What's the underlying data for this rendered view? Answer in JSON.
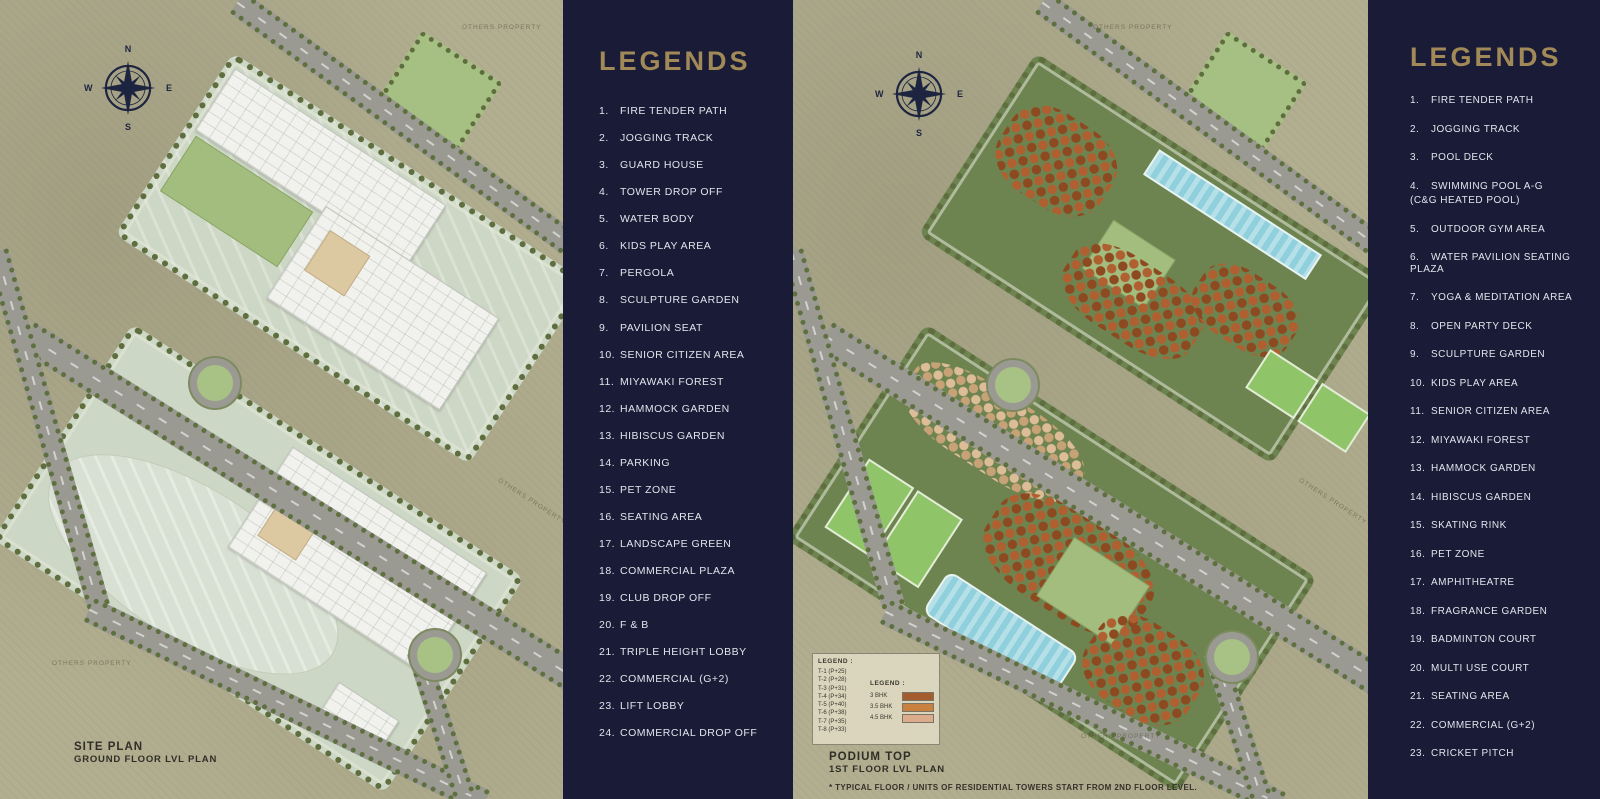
{
  "colors": {
    "panel_navy": "#191b37",
    "title_gold": "#a18a58",
    "list_text": "#e2e4ec",
    "map_ground": "#b2ae90",
    "road_gray": "#9a9a92",
    "deck_sage": "#cdd7c5",
    "lawn_green": "#a3bd7f",
    "podium_green": "#6e8450",
    "tower_rust": "#a85a28",
    "tower_beige": "#d8b894",
    "pool_blue": "#8fd0dc",
    "court_green": "#8fc468",
    "compass_navy": "#1d2440"
  },
  "left_map": {
    "plan_title": "SITE PLAN",
    "plan_subtitle": "GROUND FLOOR LVL PLAN",
    "property_label": "OTHERS PROPERTY",
    "compass": {
      "n": "N",
      "e": "E",
      "s": "S",
      "w": "W"
    }
  },
  "left_panel": {
    "title": "LEGENDS",
    "items": [
      {
        "n": "1.",
        "label": "FIRE TENDER PATH"
      },
      {
        "n": "2.",
        "label": "JOGGING TRACK"
      },
      {
        "n": "3.",
        "label": "GUARD HOUSE"
      },
      {
        "n": "4.",
        "label": "TOWER DROP OFF"
      },
      {
        "n": "5.",
        "label": "WATER BODY"
      },
      {
        "n": "6.",
        "label": "KIDS PLAY AREA"
      },
      {
        "n": "7.",
        "label": "PERGOLA"
      },
      {
        "n": "8.",
        "label": "SCULPTURE GARDEN"
      },
      {
        "n": "9.",
        "label": "PAVILION SEAT"
      },
      {
        "n": "10.",
        "label": "SENIOR CITIZEN AREA"
      },
      {
        "n": "11.",
        "label": "MIYAWAKI FOREST"
      },
      {
        "n": "12.",
        "label": "HAMMOCK GARDEN"
      },
      {
        "n": "13.",
        "label": "HIBISCUS GARDEN"
      },
      {
        "n": "14.",
        "label": "PARKING"
      },
      {
        "n": "15.",
        "label": "PET ZONE"
      },
      {
        "n": "16.",
        "label": "SEATING AREA"
      },
      {
        "n": "17.",
        "label": "LANDSCAPE GREEN"
      },
      {
        "n": "18.",
        "label": "COMMERCIAL PLAZA"
      },
      {
        "n": "19.",
        "label": "CLUB DROP OFF"
      },
      {
        "n": "20.",
        "label": "F & B"
      },
      {
        "n": "21.",
        "label": "TRIPLE HEIGHT LOBBY"
      },
      {
        "n": "22.",
        "label": "COMMERCIAL (G+2)"
      },
      {
        "n": "23.",
        "label": "LIFT LOBBY"
      },
      {
        "n": "24.",
        "label": "COMMERCIAL DROP OFF"
      }
    ]
  },
  "right_map": {
    "plan_title": "PODIUM TOP",
    "plan_subtitle": "1ST FLOOR LVL PLAN",
    "disclaimer": "* TYPICAL FLOOR / UNITS OF RESIDENTIAL TOWERS START FROM 2ND FLOOR LEVEL.",
    "property_label": "OTHERS PROPERTY",
    "compass": {
      "n": "N",
      "e": "E",
      "s": "S",
      "w": "W"
    },
    "tower_legend": {
      "heading": "LEGEND :",
      "towers": [
        {
          "label": "T-1 (P+25)"
        },
        {
          "label": "T-2 (P+28)"
        },
        {
          "label": "T-3 (P+31)"
        },
        {
          "label": "T-4 (P+34)"
        },
        {
          "label": "T-5 (P+40)"
        },
        {
          "label": "T-6 (P+38)"
        },
        {
          "label": "T-7 (P+35)"
        },
        {
          "label": "T-8 (P+33)"
        }
      ],
      "bhk_heading": "LEGEND :",
      "bhk_rows": [
        {
          "label": "3 BHK",
          "color": "#a35c2e"
        },
        {
          "label": "3.5 BHK",
          "color": "#c8813e"
        },
        {
          "label": "4.5 BHK",
          "color": "#dcab8c"
        }
      ]
    }
  },
  "right_panel": {
    "title": "LEGENDS",
    "items": [
      {
        "n": "1.",
        "label": "FIRE TENDER PATH"
      },
      {
        "n": "2.",
        "label": "JOGGING TRACK"
      },
      {
        "n": "3.",
        "label": "POOL DECK"
      },
      {
        "n": "4.",
        "label": "SWIMMING POOL A-G",
        "label2": "(C&G HEATED POOL)"
      },
      {
        "n": "5.",
        "label": "OUTDOOR GYM AREA"
      },
      {
        "n": "6.",
        "label": "WATER PAVILION SEATING PLAZA"
      },
      {
        "n": "7.",
        "label": "YOGA & MEDITATION AREA"
      },
      {
        "n": "8.",
        "label": "OPEN PARTY DECK"
      },
      {
        "n": "9.",
        "label": "SCULPTURE GARDEN"
      },
      {
        "n": "10.",
        "label": "KIDS PLAY AREA"
      },
      {
        "n": "11.",
        "label": "SENIOR CITIZEN AREA"
      },
      {
        "n": "12.",
        "label": "MIYAWAKI FOREST"
      },
      {
        "n": "13.",
        "label": "HAMMOCK GARDEN"
      },
      {
        "n": "14.",
        "label": "HIBISCUS GARDEN"
      },
      {
        "n": "15.",
        "label": "SKATING RINK"
      },
      {
        "n": "16.",
        "label": "PET ZONE"
      },
      {
        "n": "17.",
        "label": "AMPHITHEATRE"
      },
      {
        "n": "18.",
        "label": "FRAGRANCE GARDEN"
      },
      {
        "n": "19.",
        "label": "BADMINTON COURT"
      },
      {
        "n": "20.",
        "label": "MULTI USE COURT"
      },
      {
        "n": "21.",
        "label": "SEATING AREA"
      },
      {
        "n": "22.",
        "label": "COMMERCIAL (G+2)"
      },
      {
        "n": "23.",
        "label": "CRICKET PITCH"
      }
    ]
  }
}
